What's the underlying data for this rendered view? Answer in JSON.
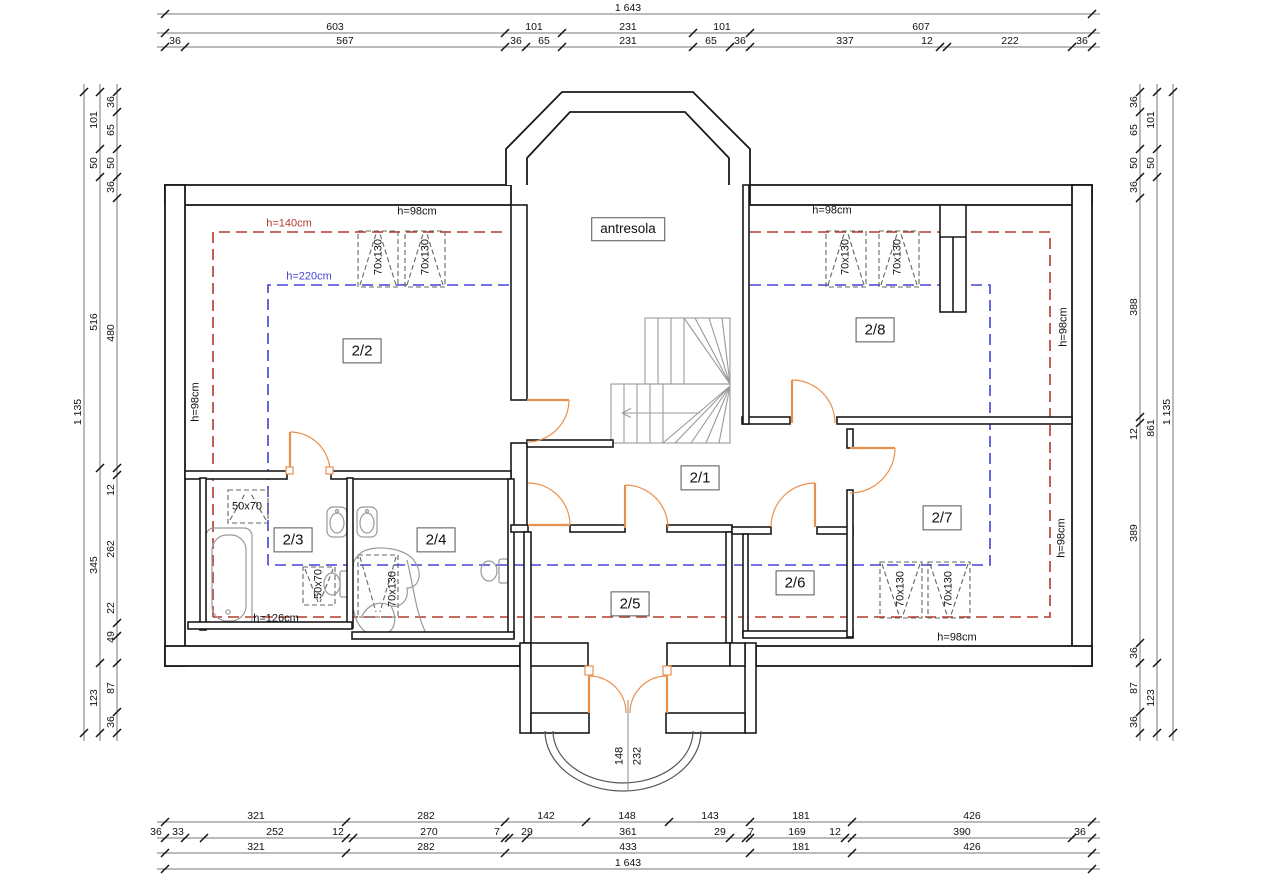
{
  "drawing": {
    "type": "floor-plan",
    "floor_label": "attic storey",
    "rooms": [
      {
        "id": "antresola",
        "label": "antresola",
        "x": 628,
        "y": 229
      },
      {
        "id": "room-2-1",
        "label": "2/1",
        "x": 700,
        "y": 478
      },
      {
        "id": "room-2-2",
        "label": "2/2",
        "x": 362,
        "y": 351
      },
      {
        "id": "room-2-3",
        "label": "2/3",
        "x": 293,
        "y": 540
      },
      {
        "id": "room-2-4",
        "label": "2/4",
        "x": 436,
        "y": 540
      },
      {
        "id": "room-2-5",
        "label": "2/5",
        "x": 630,
        "y": 604
      },
      {
        "id": "room-2-6",
        "label": "2/6",
        "x": 795,
        "y": 583
      },
      {
        "id": "room-2-7",
        "label": "2/7",
        "x": 942,
        "y": 518
      },
      {
        "id": "room-2-8",
        "label": "2/8",
        "x": 875,
        "y": 330
      }
    ],
    "annotations": [
      {
        "t": "h=98cm",
        "x": 417,
        "y": 212
      },
      {
        "t": "h=98cm",
        "x": 832,
        "y": 211
      },
      {
        "t": "h=140cm",
        "x": 289,
        "y": 224,
        "color": "red"
      },
      {
        "t": "h=220cm",
        "x": 309,
        "y": 277,
        "color": "blue"
      },
      {
        "t": "h=98cm",
        "x": 196,
        "y": 402,
        "rot": -90
      },
      {
        "t": "h=98cm",
        "x": 1064,
        "y": 327,
        "rot": -90
      },
      {
        "t": "h=98cm",
        "x": 1062,
        "y": 538,
        "rot": -90
      },
      {
        "t": "h=98cm",
        "x": 957,
        "y": 638
      },
      {
        "t": "h=126cm",
        "x": 276,
        "y": 619
      },
      {
        "t": "70x130",
        "x": 379,
        "y": 257,
        "rot": -90
      },
      {
        "t": "70x130",
        "x": 426,
        "y": 257,
        "rot": -90
      },
      {
        "t": "70x130",
        "x": 846,
        "y": 257,
        "rot": -90
      },
      {
        "t": "70x130",
        "x": 898,
        "y": 257,
        "rot": -90
      },
      {
        "t": "70x130",
        "x": 393,
        "y": 589,
        "rot": -90
      },
      {
        "t": "70x130",
        "x": 901,
        "y": 589,
        "rot": -90
      },
      {
        "t": "70x130",
        "x": 949,
        "y": 589,
        "rot": -90
      },
      {
        "t": "50x70",
        "x": 247,
        "y": 507
      },
      {
        "t": "50x70",
        "x": 319,
        "y": 584,
        "rot": -90
      },
      {
        "t": "148",
        "x": 620,
        "y": 756,
        "rot": -90
      },
      {
        "t": "232",
        "x": 638,
        "y": 756,
        "rot": -90
      }
    ]
  },
  "dimensions": {
    "chains": [
      {
        "name": "top-total",
        "axis": "h",
        "at": 14,
        "from": 165,
        "to": 1092,
        "ticks": [
          165,
          1092
        ],
        "labels": [
          {
            "t": "1 643",
            "p": 628
          }
        ]
      },
      {
        "name": "top-major",
        "axis": "h",
        "at": 33,
        "from": 165,
        "to": 1092,
        "ticks": [
          165,
          505,
          562,
          693,
          750,
          1092
        ],
        "labels": [
          {
            "t": "603",
            "p": 335
          },
          {
            "t": "101",
            "p": 534
          },
          {
            "t": "231",
            "p": 628
          },
          {
            "t": "101",
            "p": 722
          },
          {
            "t": "607",
            "p": 921
          }
        ]
      },
      {
        "name": "top-minor",
        "axis": "h",
        "at": 47,
        "from": 165,
        "to": 1092,
        "ticks": [
          165,
          185,
          505,
          526,
          562,
          693,
          730,
          750,
          940,
          947,
          1072,
          1092
        ],
        "labels": [
          {
            "t": "36",
            "p": 175
          },
          {
            "t": "567",
            "p": 345
          },
          {
            "t": "36",
            "p": 516
          },
          {
            "t": "65",
            "p": 544
          },
          {
            "t": "231",
            "p": 628
          },
          {
            "t": "65",
            "p": 711
          },
          {
            "t": "36",
            "p": 740
          },
          {
            "t": "337",
            "p": 845
          },
          {
            "t": "12",
            "p": 927
          },
          {
            "t": "222",
            "p": 1010
          },
          {
            "t": "36",
            "p": 1082
          }
        ]
      },
      {
        "name": "bottom-rooms",
        "axis": "h",
        "at": 822,
        "from": 165,
        "to": 1092,
        "ticks": [
          165,
          346,
          505,
          586,
          669,
          750,
          852,
          1092
        ],
        "labels": [
          {
            "t": "321",
            "p": 256
          },
          {
            "t": "282",
            "p": 426
          },
          {
            "t": "142",
            "p": 546
          },
          {
            "t": "148",
            "p": 627
          },
          {
            "t": "143",
            "p": 710
          },
          {
            "t": "181",
            "p": 801
          },
          {
            "t": "426",
            "p": 972
          }
        ]
      },
      {
        "name": "bottom-minor",
        "axis": "h",
        "at": 838,
        "from": 165,
        "to": 1092,
        "ticks": [
          165,
          185,
          204,
          346,
          353,
          505,
          509,
          526,
          730,
          746,
          750,
          845,
          852,
          1072,
          1092
        ],
        "labels": [
          {
            "t": "36",
            "p": 156
          },
          {
            "t": "33",
            "p": 178
          },
          {
            "t": "252",
            "p": 275
          },
          {
            "t": "12",
            "p": 338
          },
          {
            "t": "270",
            "p": 429
          },
          {
            "t": "7",
            "p": 497
          },
          {
            "t": "29",
            "p": 527
          },
          {
            "t": "361",
            "p": 628
          },
          {
            "t": "29",
            "p": 720
          },
          {
            "t": "7",
            "p": 751
          },
          {
            "t": "169",
            "p": 797
          },
          {
            "t": "12",
            "p": 835
          },
          {
            "t": "390",
            "p": 962
          },
          {
            "t": "36",
            "p": 1080
          }
        ]
      },
      {
        "name": "bottom-major",
        "axis": "h",
        "at": 853,
        "from": 165,
        "to": 1092,
        "ticks": [
          165,
          346,
          505,
          750,
          852,
          1092
        ],
        "labels": [
          {
            "t": "321",
            "p": 256
          },
          {
            "t": "282",
            "p": 426
          },
          {
            "t": "433",
            "p": 628
          },
          {
            "t": "181",
            "p": 801
          },
          {
            "t": "426",
            "p": 972
          }
        ]
      },
      {
        "name": "bottom-total",
        "axis": "h",
        "at": 869,
        "from": 165,
        "to": 1092,
        "ticks": [
          165,
          1092
        ],
        "labels": [
          {
            "t": "1 643",
            "p": 628
          }
        ]
      },
      {
        "name": "left-total",
        "axis": "v",
        "at": 84,
        "from": 92,
        "to": 733,
        "ticks": [
          92,
          733
        ],
        "labels": [
          {
            "t": "1 135",
            "p": 412
          }
        ]
      },
      {
        "name": "left-major",
        "axis": "v",
        "at": 100,
        "from": 92,
        "to": 733,
        "ticks": [
          92,
          149,
          177,
          468,
          663,
          733
        ],
        "labels": [
          {
            "t": "101",
            "p": 120
          },
          {
            "t": "50",
            "p": 163
          },
          {
            "t": "516",
            "p": 322
          },
          {
            "t": "345",
            "p": 565
          },
          {
            "t": "123",
            "p": 698
          }
        ]
      },
      {
        "name": "left-minor",
        "axis": "v",
        "at": 117,
        "from": 92,
        "to": 733,
        "ticks": [
          92,
          112,
          149,
          177,
          198,
          468,
          475,
          623,
          636,
          663,
          712,
          733
        ],
        "labels": [
          {
            "t": "36",
            "p": 102
          },
          {
            "t": "65",
            "p": 130
          },
          {
            "t": "50",
            "p": 163
          },
          {
            "t": "36",
            "p": 187
          },
          {
            "t": "480",
            "p": 333
          },
          {
            "t": "12",
            "p": 490
          },
          {
            "t": "262",
            "p": 549
          },
          {
            "t": "22",
            "p": 608
          },
          {
            "t": "49",
            "p": 637
          },
          {
            "t": "87",
            "p": 688
          },
          {
            "t": "36",
            "p": 722
          }
        ]
      },
      {
        "name": "right-minor",
        "axis": "v",
        "at": 1140,
        "from": 92,
        "to": 733,
        "ticks": [
          92,
          112,
          149,
          177,
          198,
          417,
          423,
          643,
          663,
          712,
          733
        ],
        "labels": [
          {
            "t": "36",
            "p": 102
          },
          {
            "t": "65",
            "p": 130
          },
          {
            "t": "50",
            "p": 163
          },
          {
            "t": "36",
            "p": 187
          },
          {
            "t": "388",
            "p": 307
          },
          {
            "t": "12",
            "p": 434
          },
          {
            "t": "389",
            "p": 533
          },
          {
            "t": "36",
            "p": 653
          },
          {
            "t": "87",
            "p": 688
          },
          {
            "t": "36",
            "p": 722
          }
        ]
      },
      {
        "name": "right-major",
        "axis": "v",
        "at": 1157,
        "from": 92,
        "to": 733,
        "ticks": [
          92,
          149,
          177,
          663,
          733
        ],
        "labels": [
          {
            "t": "101",
            "p": 120
          },
          {
            "t": "50",
            "p": 163
          },
          {
            "t": "861",
            "p": 428
          },
          {
            "t": "123",
            "p": 698
          }
        ]
      },
      {
        "name": "right-total",
        "axis": "v",
        "at": 1173,
        "from": 92,
        "to": 733,
        "ticks": [
          92,
          733
        ],
        "labels": [
          {
            "t": "1 135",
            "p": 412
          }
        ]
      }
    ]
  },
  "colors": {
    "red": "#b03a2e",
    "blue": "#4343d6",
    "orange": "#e8914f",
    "wall": "#1a1a1a",
    "fixture_gray": "#9a9a9a",
    "dim_gray": "#777777"
  }
}
